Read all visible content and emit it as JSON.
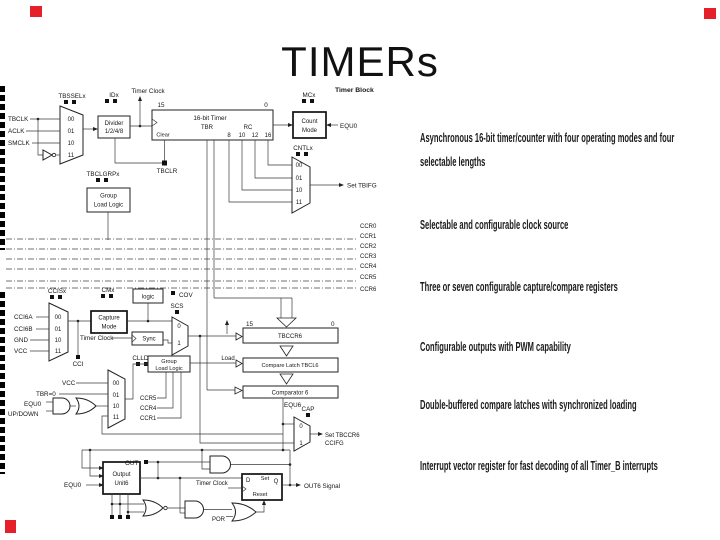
{
  "slide": {
    "title": "TIMERs"
  },
  "bullets": [
    "Asynchronous 16-bit timer/counter with four operating modes and four selectable lengths",
    "Selectable and configurable clock source",
    "Three or seven configurable capture/compare registers",
    "Configurable outputs with PWM capability",
    "Double-buffered compare latches with synchronized loading",
    "Interrupt vector register for fast decoding of all Timer_B interrupts"
  ],
  "diagram": {
    "header": "Timer Block",
    "labels": {
      "tbsselx": "TBSSELx",
      "tbclk": "TBCLK",
      "aclk": "ACLK",
      "smclk": "SMCLK",
      "b00": "00",
      "b01": "01",
      "b10": "10",
      "b11": "11",
      "idx": "IDx",
      "divider": "Divider",
      "divider_ratio": "1/2/4/8",
      "timer_clock": "Timer Clock",
      "bit15": "15",
      "bit0": "0",
      "timer_name": "16-bit Timer",
      "tbr": "TBR",
      "rc": "RC",
      "clear": "Clear",
      "len8": "8",
      "len10": "10",
      "len12": "12",
      "len16": "16",
      "tbclr": "TBCLR",
      "tbclgrpx": "TBCLGRPx",
      "group": "Group",
      "load_logic": "Load Logic",
      "mcx": "MCx",
      "count": "Count",
      "mode": "Mode",
      "equ0": "EQU0",
      "cntlx": "CNTLx",
      "set_tbifg": "Set TBIFG",
      "ccr0": "CCR0",
      "ccr1": "CCR1",
      "ccr2": "CCR2",
      "ccr3": "CCR3",
      "ccr4": "CCR4",
      "ccr5": "CCR5",
      "ccr6": "CCR6",
      "ccisx": "CCISx",
      "cci6a": "CCI6A",
      "cci6b": "CCI6B",
      "gnd": "GND",
      "vcc": "VCC",
      "cmx": "CMx",
      "capture": "Capture",
      "logic": "logic",
      "cov": "COV",
      "scs": "SCS",
      "b0": "0",
      "b1": "1",
      "sync": "Sync",
      "cci": "CCI",
      "clldx": "CLLDx",
      "tbr_zero": "TBR=0",
      "up_down": "UP/DOWN",
      "load": "Load",
      "tbccr6": "TBCCR6",
      "compare_latch": "Compare Latch TBCL6",
      "comparator6": "Comparator 6",
      "equ6": "EQU6",
      "cap": "CAP",
      "set_tbccr6": "Set TBCCR6",
      "ccifg": "CCIFG",
      "out": "OUT",
      "output": "Output",
      "unit6": "Unit6",
      "d": "D",
      "set": "Set",
      "q": "Q",
      "reset": "Reset",
      "out6_signal": "OUT6 Signal",
      "por": "POR"
    }
  },
  "colors": {
    "accent_red": "#e5202a",
    "red_bg": "background-color:#e5202a",
    "line": "#333333"
  }
}
